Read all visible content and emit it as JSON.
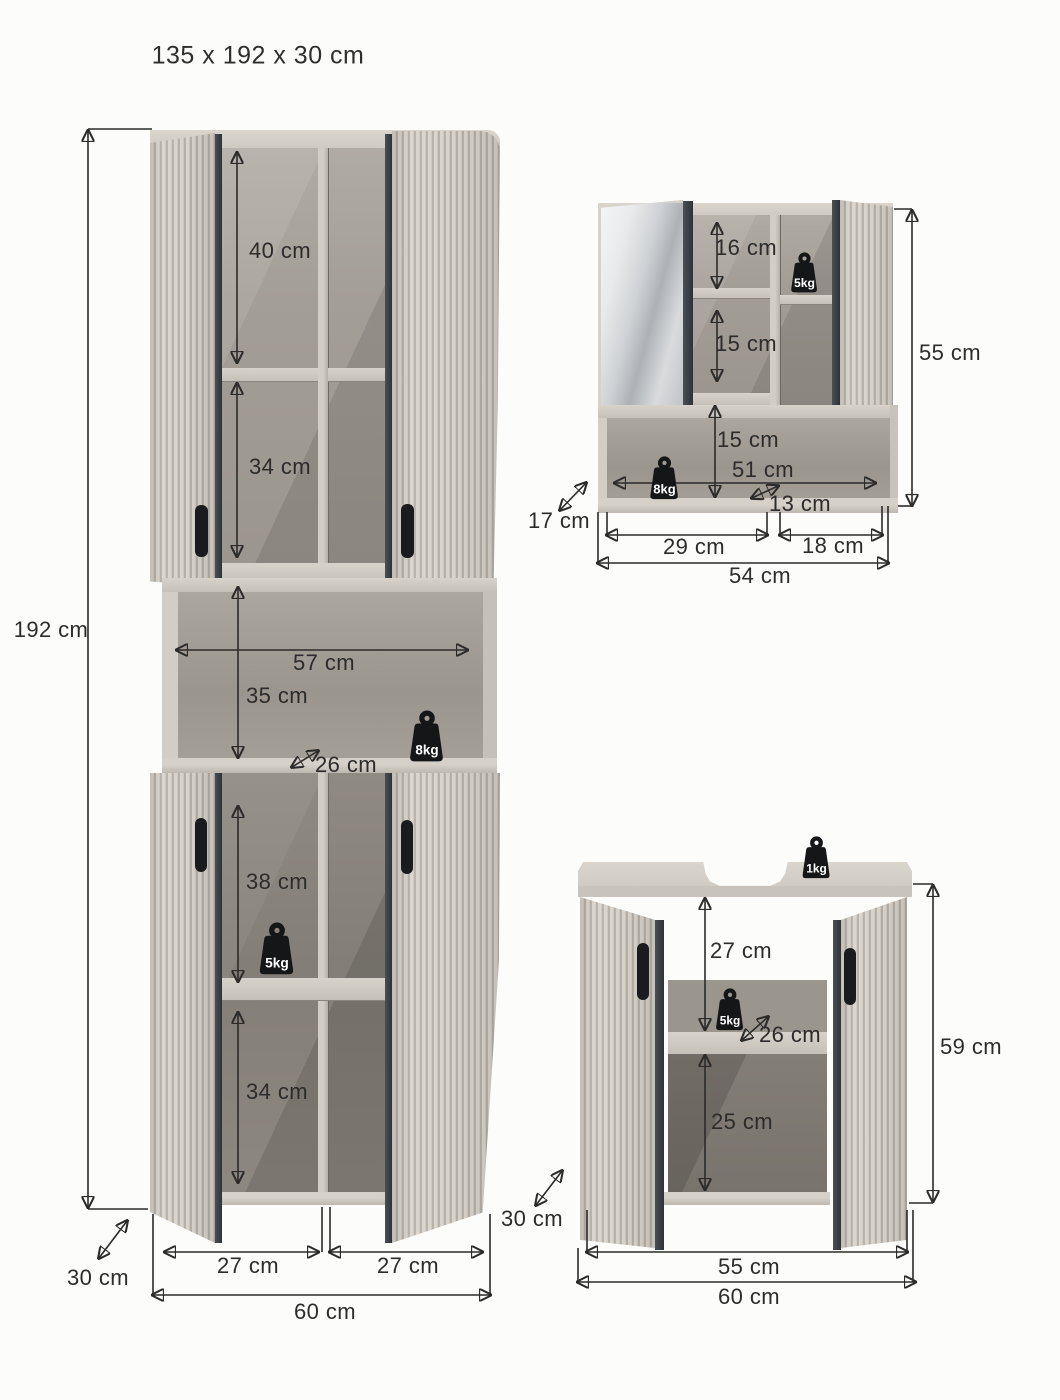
{
  "title": "135 x 192 x 30 cm",
  "tall_cabinet": {
    "height": "192 cm",
    "top_compartment": "40 cm",
    "second_compartment": "34 cm",
    "niche": {
      "width": "57 cm",
      "height": "35 cm",
      "depth": "26 cm",
      "max_load": "8kg"
    },
    "third_compartment": "38 cm",
    "shelf_max_load": "5kg",
    "bottom_compartment": "34 cm",
    "left_door_width": "27 cm",
    "right_door_width": "27 cm",
    "width": "60 cm",
    "depth_left": "30 cm",
    "depth_right": "30 cm"
  },
  "mirror_cabinet": {
    "top_compartment": "16 cm",
    "middle_compartment": "15 cm",
    "shelf_max_load": "5kg",
    "open_shelf": {
      "height": "15 cm",
      "width": "51 cm",
      "inner_depth": "13 cm",
      "max_load": "8kg"
    },
    "depth": "17 cm",
    "left_section_width": "29 cm",
    "right_section_width": "18 cm",
    "width": "54 cm",
    "height": "55 cm"
  },
  "sink_cabinet": {
    "top_max_load": "1kg",
    "upper_compartment": "27 cm",
    "shelf_max_load": "5kg",
    "shelf_depth": "26 cm",
    "lower_compartment": "25 cm",
    "inner_width": "55 cm",
    "width": "60 cm",
    "height": "59 cm"
  }
}
